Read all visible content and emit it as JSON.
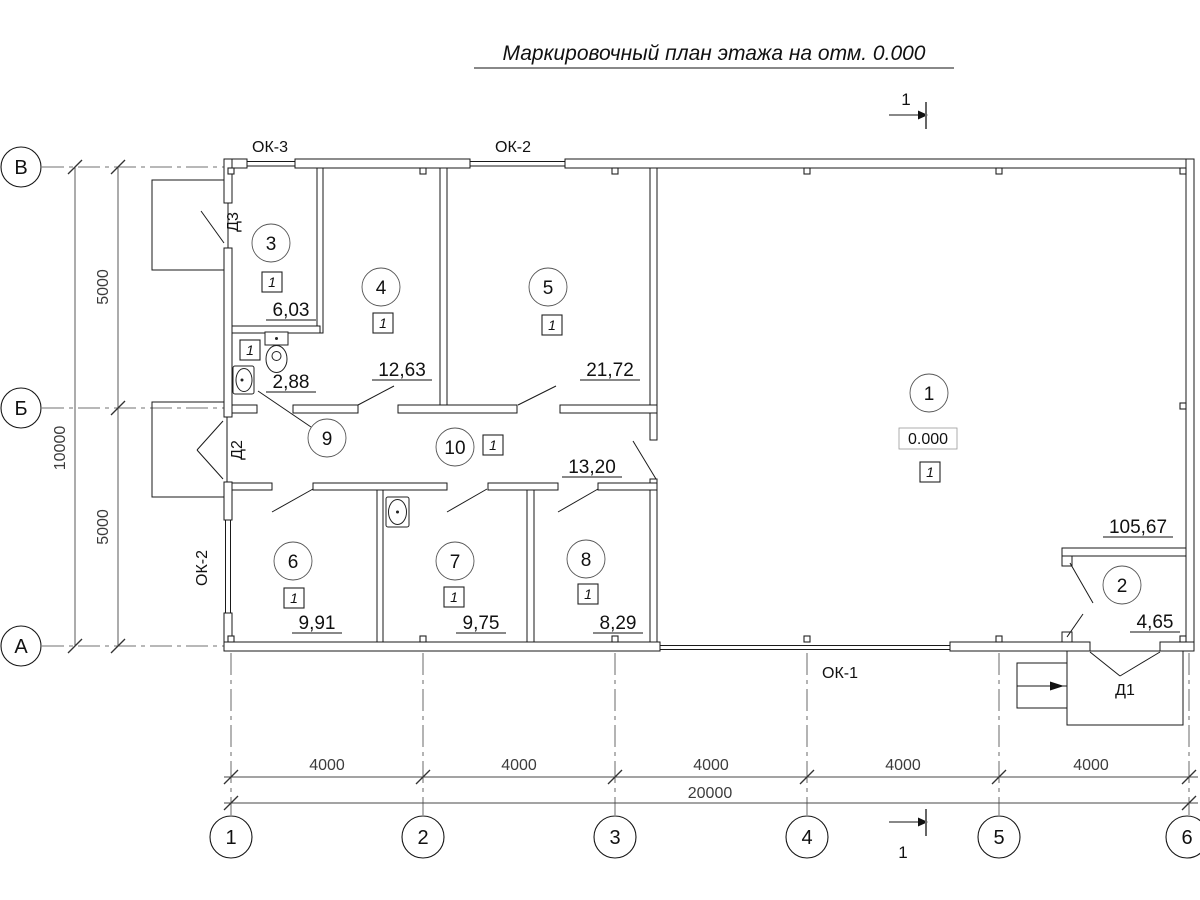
{
  "title": "Маркировочный план этажа на отм. 0.000",
  "section_mark": {
    "label": "1"
  },
  "axes": {
    "rows": [
      {
        "label": "В"
      },
      {
        "label": "Б"
      },
      {
        "label": "А"
      }
    ],
    "cols": [
      {
        "label": "1"
      },
      {
        "label": "2"
      },
      {
        "label": "3"
      },
      {
        "label": "4"
      },
      {
        "label": "5"
      },
      {
        "label": "6"
      }
    ]
  },
  "dimensions": {
    "left": {
      "upper": "5000",
      "lower": "5000",
      "total": "10000"
    },
    "bottom": {
      "bays": [
        "4000",
        "4000",
        "4000",
        "4000",
        "4000"
      ],
      "total": "20000"
    }
  },
  "openings": {
    "window_top_left": "ОК-3",
    "window_top_center": "ОК-2",
    "window_left": "ОК-2",
    "window_bottom": "ОК-1",
    "door_main": "Д1",
    "door_side": "Д2",
    "door_back": "Д3"
  },
  "level_mark": "0.000",
  "rooms": {
    "r1": {
      "num": "1",
      "area": "105,67",
      "floor": "1"
    },
    "r2": {
      "num": "2",
      "area": "4,65"
    },
    "r3": {
      "num": "3",
      "area": "6,03",
      "floor": "1"
    },
    "r4": {
      "num": "4",
      "area": "12,63",
      "floor": "1"
    },
    "r5": {
      "num": "5",
      "area": "21,72",
      "floor": "1"
    },
    "r6": {
      "num": "6",
      "area": "9,91",
      "floor": "1"
    },
    "r7": {
      "num": "7",
      "area": "9,75",
      "floor": "1"
    },
    "r8": {
      "num": "8",
      "area": "8,29",
      "floor": "1"
    },
    "r9": {
      "num": "9",
      "area": "2,88",
      "floor": "1"
    },
    "r10": {
      "num": "10",
      "area": "13,20",
      "floor": "1"
    }
  },
  "colors": {
    "line": "#1a1a1a",
    "dim": "#3c3c3c",
    "background": "#ffffff"
  }
}
